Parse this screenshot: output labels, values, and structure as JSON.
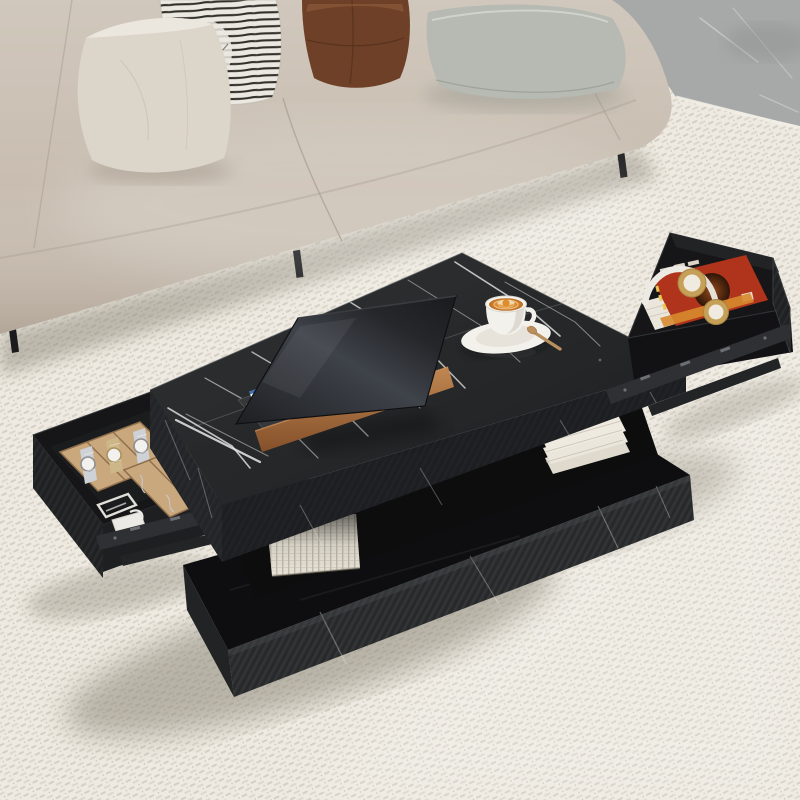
{
  "image": {
    "type": "product-lifestyle-photo",
    "subject": "Black faux-marble coffee table with two open pull-out storage drawers, styled in a bright living room",
    "visible_text": "none"
  },
  "scene": {
    "room": {
      "rug": "cream chunky-woven area rug with diagonal weave rows",
      "floor": "grey marble tile visible in top-right corner",
      "lighting": "soft daylight with diffuse shadows"
    },
    "sofa": {
      "description": "beige taupe fabric sofa across the top of the frame",
      "legs": "thin black metal legs",
      "pillows": [
        {
          "name": "white-velvet-pillow"
        },
        {
          "name": "black-white-striped-pillow"
        },
        {
          "name": "brown-suede-pillow"
        },
        {
          "name": "grey-flat-cushion"
        }
      ]
    },
    "coffee_table": {
      "top": "rectangular black faux-marble top with white veining",
      "base": "floating black plinth base with ribbed marble sides",
      "middle": "open storage gap between top and base",
      "left_drawer": {
        "state": "open",
        "contents": [
          "wooden watch organizer tray with three watches",
          "wooden jewelry tray with six compartments holding necklaces and a bead bracelet",
          "white charger cube with coiled white cable"
        ]
      },
      "right_drawer": {
        "state": "open",
        "contents": [
          "orange magazine with dark sphere artwork",
          "white book",
          "gold and white wireless headphones"
        ]
      },
      "under_shelf_items": [
        "white woven storage basket",
        "stack of white books"
      ]
    },
    "tabletop_items": {
      "laptop": "dark laptop standing open on a copper-wood riser, gold backlit keys visible at left",
      "coffee": "white cappuccino cup with latte art on a saucer with a small wooden spoon"
    }
  },
  "colors": {
    "rug": "#eeeae1",
    "rug_dash": "#c9c3b4",
    "rug_dash2": "#a9a295",
    "floor_marble": "#a6a9a8",
    "floor_vein": "#d9dbd9",
    "sofa": "#c8bdb0",
    "sofa_seam": "#a79c8d",
    "pillow_white": "#dcd5ca",
    "pillow_stripe_bg": "#ebe8e1",
    "pillow_stripe": "#33302b",
    "pillow_brown": "#7c4a2f",
    "pillow_gray": "#b6bab3",
    "leg": "#1b1b1d",
    "marble_top": "#181a1c",
    "marble_vein": "#e9e9e7",
    "slab_side": "#25272b",
    "slab_side_dark": "#1e2023",
    "base_top": "#0e0e10",
    "base_front": "#2d2f31",
    "shelf": "#0d0d0e",
    "drawer_interior": "#161618",
    "drawer_floor": "#1b1c1e",
    "drawer_panel": "#232526",
    "rail": "#2e3033",
    "rail_mark": "#6c7074",
    "tray_wood": "#c9a87e",
    "tray_line": "#8f6f4b",
    "watch_silver": "#ced1d5",
    "watch_gold": "#cdb687",
    "watch_face": "#f2f1ed",
    "magazine_red": "#c23a20",
    "magazine_yellow": "#e9c94f",
    "headphone_gold": "#c6a058",
    "headphone_white": "#eceae3",
    "book_white": "#eae6dc",
    "basket": "#e9e4d8",
    "basket_line": "#b9b2a2",
    "laptop_deck": "#35373a",
    "key_gold": "#c79a4e",
    "sticker_blue": "#3d6fb4",
    "copper": "#a4653a",
    "cup_white": "#f3f1ec",
    "latte_cream": "#f2e2bd",
    "spoon": "#b98f5d",
    "shadow": "#8d8779",
    "white_cable": "#eceae5"
  }
}
